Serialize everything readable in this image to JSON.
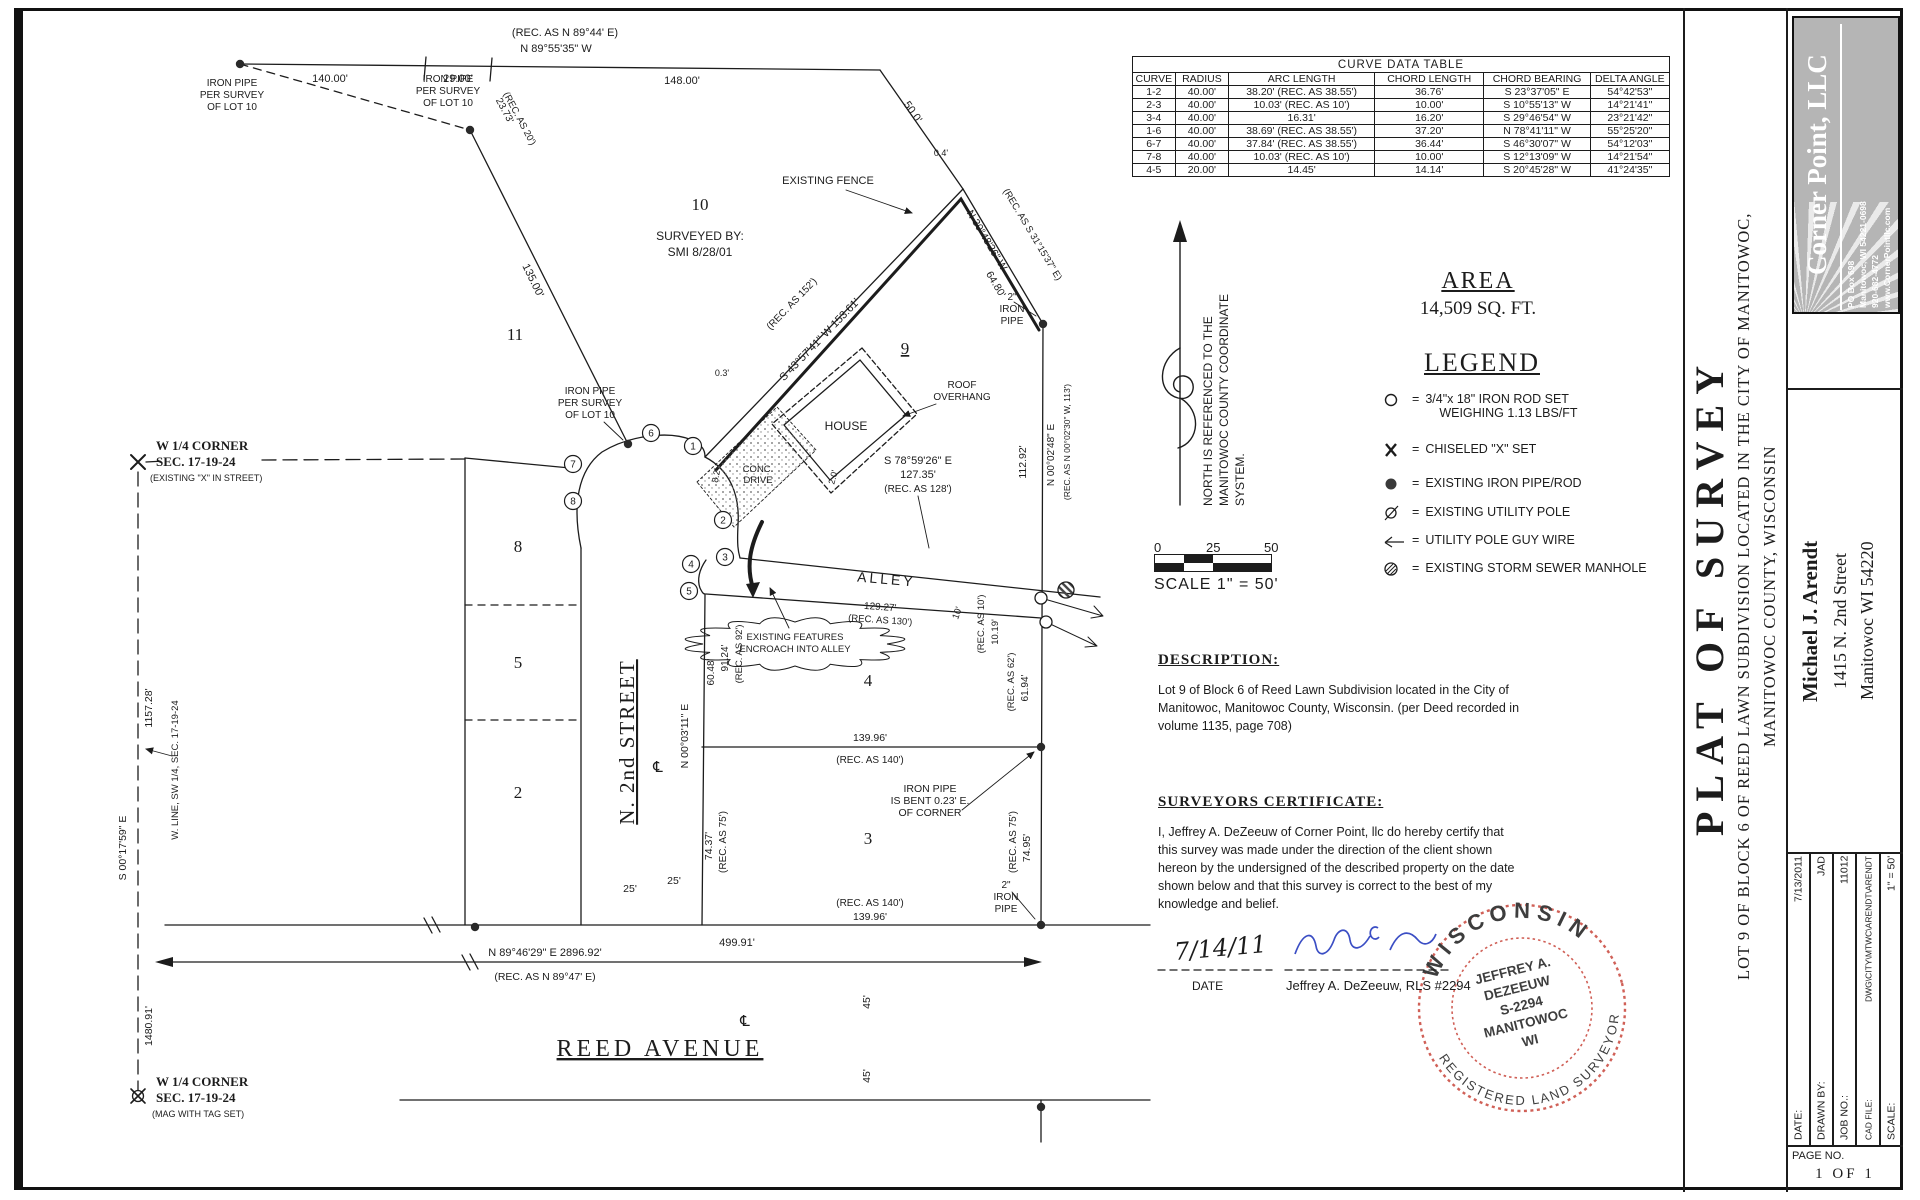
{
  "page": {
    "bg": "#ffffff",
    "ink": "#1c1c1c",
    "accent_red": "#c8453a",
    "accent_blue": "#3b4ec4",
    "logo_gray": "#b5b5b5"
  },
  "curve_table": {
    "title": "CURVE DATA TABLE",
    "headers": [
      "CURVE",
      "RADIUS",
      "ARC LENGTH",
      "CHORD LENGTH",
      "CHORD BEARING",
      "DELTA ANGLE"
    ],
    "rows": [
      [
        "1-2",
        "40.00'",
        "38.20'  (REC. AS 38.55')",
        "36.76'",
        "S 23°37'05\" E",
        "54°42'53\""
      ],
      [
        "2-3",
        "40.00'",
        "10.03'  (REC. AS 10')",
        "10.00'",
        "S 10°55'13\" W",
        "14°21'41\""
      ],
      [
        "3-4",
        "40.00'",
        "16.31'",
        "16.20'",
        "S 29°46'54\" W",
        "23°21'42\""
      ],
      [
        "1-6",
        "40.00'",
        "38.69'  (REC. AS 38.55')",
        "37.20'",
        "N 78°41'11\" W",
        "55°25'20\""
      ],
      [
        "6-7",
        "40.00'",
        "37.84'  (REC. AS 38.55')",
        "36.44'",
        "S 46°30'07\" W",
        "54°12'03\""
      ],
      [
        "7-8",
        "40.00'",
        "10.03'  (REC. AS 10')",
        "10.00'",
        "S 12°13'09\" W",
        "14°21'54\""
      ],
      [
        "4-5",
        "20.00'",
        "14.45'",
        "14.14'",
        "S 20°45'28\" W",
        "41°24'35\""
      ]
    ]
  },
  "area": {
    "heading": "AREA",
    "value": "14,509 SQ. FT."
  },
  "legend": {
    "heading": "LEGEND",
    "items": [
      {
        "icon": "iron-rod-set-icon",
        "label": "3/4\"x 18\" IRON ROD SET",
        "label2": "WEIGHING 1.13 LBS/FT"
      },
      {
        "icon": "chiseled-x-icon",
        "label": "CHISELED \"X\" SET"
      },
      {
        "icon": "iron-pipe-icon",
        "label": "EXISTING IRON PIPE/ROD"
      },
      {
        "icon": "utility-pole-icon",
        "label": "EXISTING UTILITY POLE"
      },
      {
        "icon": "guy-wire-icon",
        "label": "UTILITY POLE GUY WIRE"
      },
      {
        "icon": "manhole-icon",
        "label": "EXISTING STORM SEWER MANHOLE"
      }
    ]
  },
  "scale_bar": {
    "ticks": [
      "0",
      "25",
      "50"
    ],
    "caption": "SCALE 1\" = 50'"
  },
  "description": {
    "heading": "DESCRIPTION:",
    "lines": [
      "Lot 9 of Block 6 of Reed Lawn Subdivision located in the City of",
      "Manitowoc, Manitowoc County, Wisconsin. (per Deed recorded in",
      "volume 1135, page 708)"
    ]
  },
  "certificate": {
    "heading": "SURVEYORS CERTIFICATE:",
    "lines": [
      "I, Jeffrey A. DeZeeuw of Corner Point, llc do hereby certify that",
      "this survey was made under the direction of the client shown",
      "hereon by the undersigned of the described property on the date",
      "shown below and that this survey is correct to the best of my",
      "knowledge and belief."
    ]
  },
  "stamp": {
    "top": "WISCONSIN",
    "bottom": "REGISTERED LAND SURVEYOR",
    "center": [
      "JEFFREY A.",
      "DEZEEUW",
      "S-2294",
      "MANITOWOC",
      "WI"
    ]
  },
  "title_block": {
    "company": {
      "name": "Corner Point, LLC",
      "lines": [
        "PO Box 698",
        "Manitowoc, WI 54221-0698",
        "920-682-4772",
        "www.CornerPointllc.com"
      ]
    },
    "title": "PLAT OF SURVEY",
    "subtitle1": "LOT 9 OF BLOCK 6 OF REED LAWN SUBDIVISION LOCATED IN THE CITY OF MANITOWOC,",
    "subtitle2": "MANITOWOC COUNTY, WISCONSIN",
    "client": [
      "Michael J. Arendt",
      "1415 N. 2nd Street",
      "Manitowoc WI 54220"
    ],
    "info": [
      [
        "DATE:",
        "7/13/2011"
      ],
      [
        "DRAWN BY:",
        "JAD"
      ],
      [
        "JOB NO.:",
        "11012"
      ],
      [
        "CAD FILE:",
        "DWG\\CITY\\MTWC\\ARENDT\\ARENDT"
      ],
      [
        "SCALE:",
        "1\" = 50'"
      ]
    ],
    "page_label": "PAGE NO.",
    "page_value": "1 OF 1"
  },
  "drawing": {
    "labels": [
      {
        "t": "(REC. AS N 89°44' E)",
        "x": 565,
        "y": 36,
        "s": 11
      },
      {
        "t": "N 89°55'35\" W",
        "x": 556,
        "y": 52,
        "s": 11
      },
      {
        "t": "140.00'",
        "x": 330,
        "y": 82,
        "s": 11
      },
      {
        "t": "29.00'",
        "x": 458,
        "y": 82,
        "s": 11
      },
      {
        "t": "148.00'",
        "x": 682,
        "y": 84,
        "s": 11
      },
      {
        "t": "IRON PIPE",
        "x": 232,
        "y": 86,
        "s": 10
      },
      {
        "t": "PER SURVEY",
        "x": 232,
        "y": 98,
        "s": 10
      },
      {
        "t": "OF LOT 10",
        "x": 232,
        "y": 110,
        "s": 10
      },
      {
        "t": "IRON PIPE",
        "x": 448,
        "y": 82,
        "s": 10
      },
      {
        "t": "PER SURVEY",
        "x": 448,
        "y": 94,
        "s": 10
      },
      {
        "t": "OF LOT 10",
        "x": 448,
        "y": 106,
        "s": 10
      },
      {
        "t": "23.73'",
        "x": 502,
        "y": 112,
        "r": 62,
        "s": 10
      },
      {
        "t": "(REC. AS 20')",
        "x": 517,
        "y": 120,
        "r": 62,
        "s": 9.5
      },
      {
        "t": "135.00'",
        "x": 530,
        "y": 282,
        "r": 64,
        "s": 11
      },
      {
        "t": "50.0'",
        "x": 910,
        "y": 114,
        "r": 55,
        "s": 11
      },
      {
        "t": "0.4'",
        "x": 941,
        "y": 156,
        "s": 9
      },
      {
        "t": "EXISTING FENCE",
        "x": 828,
        "y": 184,
        "s": 11
      },
      {
        "t": "(REC. AS S 31°15'37\" E)",
        "x": 1030,
        "y": 236,
        "r": 59,
        "s": 9.5
      },
      {
        "t": "N 30°48'26\" W",
        "x": 984,
        "y": 242,
        "r": 59,
        "s": 10.5
      },
      {
        "t": "64.80'",
        "x": 993,
        "y": 286,
        "r": 59,
        "s": 10.5
      },
      {
        "t": "2\"",
        "x": 1012,
        "y": 300,
        "s": 10
      },
      {
        "t": "IRON",
        "x": 1012,
        "y": 312,
        "s": 10
      },
      {
        "t": "PIPE",
        "x": 1012,
        "y": 324,
        "s": 10
      },
      {
        "t": "10",
        "x": 700,
        "y": 210,
        "s": 17,
        "f": "serif"
      },
      {
        "t": "SURVEYED BY:",
        "x": 700,
        "y": 240,
        "s": 12
      },
      {
        "t": "SMI 8/28/01",
        "x": 700,
        "y": 256,
        "s": 12
      },
      {
        "t": "11",
        "x": 515,
        "y": 340,
        "s": 17,
        "f": "serif"
      },
      {
        "t": "9",
        "x": 905,
        "y": 354,
        "s": 17,
        "f": "serif",
        "u": 1
      },
      {
        "t": "HOUSE",
        "x": 846,
        "y": 430,
        "s": 12
      },
      {
        "t": "ROOF",
        "x": 962,
        "y": 388,
        "s": 10
      },
      {
        "t": "OVERHANG",
        "x": 962,
        "y": 400,
        "s": 10
      },
      {
        "t": "(REC. AS 152')",
        "x": 794,
        "y": 306,
        "r": -46,
        "s": 10
      },
      {
        "t": "S 43°57'41\" W  153.61'",
        "x": 822,
        "y": 342,
        "r": -46,
        "s": 11
      },
      {
        "t": "0.3'",
        "x": 722,
        "y": 376,
        "s": 9
      },
      {
        "t": "S 78°59'26\" E",
        "x": 918,
        "y": 464,
        "s": 11
      },
      {
        "t": "127.35'",
        "x": 918,
        "y": 478,
        "s": 11
      },
      {
        "t": "(REC. AS 128')",
        "x": 918,
        "y": 492,
        "s": 10
      },
      {
        "t": "112.92'",
        "x": 1026,
        "y": 462,
        "r": -90,
        "s": 10.5
      },
      {
        "t": "N 00°02'48\" E",
        "x": 1054,
        "y": 455,
        "r": -90,
        "s": 10
      },
      {
        "t": "(REC. AS N 00°02'30\" W, 113')",
        "x": 1070,
        "y": 442,
        "r": -90,
        "s": 8.5
      },
      {
        "t": "8.2'",
        "x": 719,
        "y": 476,
        "r": -80,
        "s": 9
      },
      {
        "t": "CONC.",
        "x": 758,
        "y": 472,
        "s": 9.5
      },
      {
        "t": "DRIVE",
        "x": 758,
        "y": 483,
        "s": 9.5
      },
      {
        "t": "2.0'",
        "x": 836,
        "y": 478,
        "r": -75,
        "s": 9
      },
      {
        "t": "ALLEY",
        "x": 886,
        "y": 584,
        "r": 5,
        "s": 14,
        "ls": 3
      },
      {
        "t": "129.27'",
        "x": 880,
        "y": 610,
        "r": 4,
        "s": 10
      },
      {
        "t": "(REC. AS 130')",
        "x": 880,
        "y": 623,
        "r": 4,
        "s": 9.5
      },
      {
        "t": "EXISTING FEATURES",
        "x": 795,
        "y": 640,
        "s": 9.5
      },
      {
        "t": "ENCROACH INTO ALLEY",
        "x": 795,
        "y": 652,
        "s": 9.5
      },
      {
        "t": "60.48'",
        "x": 714,
        "y": 672,
        "r": -90,
        "s": 10
      },
      {
        "t": "91.24'",
        "x": 728,
        "y": 658,
        "r": -90,
        "s": 10
      },
      {
        "t": "(REC. AS 92')",
        "x": 742,
        "y": 654,
        "r": -90,
        "s": 9.5
      },
      {
        "t": "4",
        "x": 868,
        "y": 686,
        "s": 17,
        "f": "serif"
      },
      {
        "t": "10'",
        "x": 960,
        "y": 614,
        "r": -70,
        "s": 9.5
      },
      {
        "t": "(REC. AS 10')",
        "x": 984,
        "y": 624,
        "r": -90,
        "s": 9.5
      },
      {
        "t": "10.19'",
        "x": 998,
        "y": 632,
        "r": -90,
        "s": 9.5
      },
      {
        "t": "(REC. AS 62')",
        "x": 1014,
        "y": 682,
        "r": -90,
        "s": 9.5
      },
      {
        "t": "61.94'",
        "x": 1028,
        "y": 688,
        "r": -90,
        "s": 10
      },
      {
        "t": "139.96'",
        "x": 870,
        "y": 741,
        "s": 10.5
      },
      {
        "t": "(REC. AS 140')",
        "x": 870,
        "y": 763,
        "s": 10
      },
      {
        "t": "IRON PIPE",
        "x": 930,
        "y": 792,
        "s": 10.5
      },
      {
        "t": "IS BENT 0.23' E.",
        "x": 930,
        "y": 804,
        "s": 10.5
      },
      {
        "t": "OF CORNER",
        "x": 930,
        "y": 816,
        "s": 10.5
      },
      {
        "t": "N 00°03'11\" E",
        "x": 688,
        "y": 736,
        "r": -90,
        "s": 10.5
      },
      {
        "t": "74.37'",
        "x": 712,
        "y": 846,
        "r": -90,
        "s": 10.5
      },
      {
        "t": "(REC. AS 75')",
        "x": 726,
        "y": 842,
        "r": -90,
        "s": 10
      },
      {
        "t": "(REC. AS 75')",
        "x": 1016,
        "y": 842,
        "r": -90,
        "s": 10
      },
      {
        "t": "74.95'",
        "x": 1030,
        "y": 848,
        "r": -90,
        "s": 10.5
      },
      {
        "t": "3",
        "x": 868,
        "y": 844,
        "s": 17,
        "f": "serif"
      },
      {
        "t": "2\"",
        "x": 1006,
        "y": 888,
        "s": 10
      },
      {
        "t": "IRON",
        "x": 1006,
        "y": 900,
        "s": 10
      },
      {
        "t": "PIPE",
        "x": 1006,
        "y": 912,
        "s": 10
      },
      {
        "t": "(REC. AS 140')",
        "x": 870,
        "y": 906,
        "s": 10
      },
      {
        "t": "139.96'",
        "x": 870,
        "y": 920,
        "s": 10.5
      },
      {
        "t": "499.91'",
        "x": 737,
        "y": 946,
        "s": 11
      },
      {
        "t": "N 89°46'29\" E  2896.92'",
        "x": 545,
        "y": 956,
        "s": 11
      },
      {
        "t": "(REC. AS N 89°47' E)",
        "x": 545,
        "y": 980,
        "s": 10.5
      },
      {
        "t": "45'",
        "x": 870,
        "y": 1002,
        "r": -90,
        "s": 10.5
      },
      {
        "t": "45'",
        "x": 870,
        "y": 1076,
        "r": -90,
        "s": 10.5
      },
      {
        "t": "REED AVENUE",
        "x": 660,
        "y": 1056,
        "s": 24,
        "f": "serif",
        "ls": 4,
        "u": 1
      },
      {
        "t": "N. 2nd STREET",
        "x": 634,
        "y": 742,
        "r": -90,
        "s": 21,
        "f": "serif",
        "ls": 2,
        "u": 1
      },
      {
        "t": "℄",
        "x": 658,
        "y": 772,
        "s": 15
      },
      {
        "t": "℄",
        "x": 745,
        "y": 1026,
        "s": 15
      },
      {
        "t": "25'",
        "x": 630,
        "y": 892,
        "s": 10.5
      },
      {
        "t": "25'",
        "x": 674,
        "y": 884,
        "s": 10.5
      },
      {
        "t": "W 1/4 CORNER",
        "x": 156,
        "y": 450,
        "s": 13,
        "a": "s",
        "f": "serifb"
      },
      {
        "t": "SEC. 17-19-24",
        "x": 156,
        "y": 466,
        "s": 13,
        "a": "s",
        "f": "serifb"
      },
      {
        "t": "(EXISTING \"X\" IN STREET)",
        "x": 150,
        "y": 481,
        "s": 9,
        "a": "s"
      },
      {
        "t": "1157.28'",
        "x": 152,
        "y": 708,
        "r": -90,
        "s": 10.5
      },
      {
        "t": "W. LINE, SW 1/4, SEC. 17-19-24",
        "x": 178,
        "y": 770,
        "r": -90,
        "s": 9.5
      },
      {
        "t": "S 00°17'59\" E",
        "x": 126,
        "y": 848,
        "r": -90,
        "s": 10.5
      },
      {
        "t": "1480.91'",
        "x": 152,
        "y": 1026,
        "r": -90,
        "s": 10.5
      },
      {
        "t": "W 1/4 CORNER",
        "x": 156,
        "y": 1086,
        "s": 13,
        "a": "s",
        "f": "serifb"
      },
      {
        "t": "SEC. 17-19-24",
        "x": 156,
        "y": 1102,
        "s": 13,
        "a": "s",
        "f": "serifb"
      },
      {
        "t": "(MAG WITH TAG SET)",
        "x": 152,
        "y": 1117,
        "s": 9,
        "a": "s"
      },
      {
        "t": "IRON PIPE",
        "x": 590,
        "y": 394,
        "s": 10
      },
      {
        "t": "PER SURVEY",
        "x": 590,
        "y": 406,
        "s": 10
      },
      {
        "t": "OF LOT 10",
        "x": 590,
        "y": 418,
        "s": 10
      },
      {
        "t": "8",
        "x": 518,
        "y": 552,
        "s": 17,
        "f": "serif"
      },
      {
        "t": "5",
        "x": 518,
        "y": 668,
        "s": 17,
        "f": "serif"
      },
      {
        "t": "2",
        "x": 518,
        "y": 798,
        "s": 17,
        "f": "serif"
      },
      {
        "t": "NORTH IS REFERENCED TO THE",
        "x": 1212,
        "y": 506,
        "r": -90,
        "s": 12,
        "a": "s"
      },
      {
        "t": "MANITOWOC COUNTY COORDINATE",
        "x": 1228,
        "y": 506,
        "r": -90,
        "s": 12,
        "a": "s"
      },
      {
        "t": "SYSTEM.",
        "x": 1244,
        "y": 506,
        "r": -90,
        "s": 12,
        "a": "s"
      },
      {
        "t": "7/14/11",
        "x": 1175,
        "y": 960,
        "r": -5,
        "s": 24,
        "a": "s",
        "f": "hand"
      },
      {
        "t": "DATE",
        "x": 1192,
        "y": 990,
        "s": 12,
        "a": "s"
      },
      {
        "t": "Jeffrey A. DeZeeuw, RLS #2294",
        "x": 1286,
        "y": 990,
        "s": 13,
        "a": "s"
      }
    ],
    "points": [
      [
        1,
        693,
        446
      ],
      [
        2,
        723,
        520
      ],
      [
        3,
        725,
        557
      ],
      [
        4,
        691,
        564
      ],
      [
        5,
        689,
        591
      ],
      [
        6,
        651,
        433
      ],
      [
        7,
        573,
        464
      ],
      [
        8,
        573,
        501
      ]
    ],
    "dots": [
      [
        240,
        64
      ],
      [
        470,
        130
      ],
      [
        628,
        444
      ],
      [
        1043,
        324
      ],
      [
        1041,
        747
      ],
      [
        1041,
        925
      ],
      [
        475,
        927
      ],
      [
        1041,
        1107
      ]
    ]
  }
}
